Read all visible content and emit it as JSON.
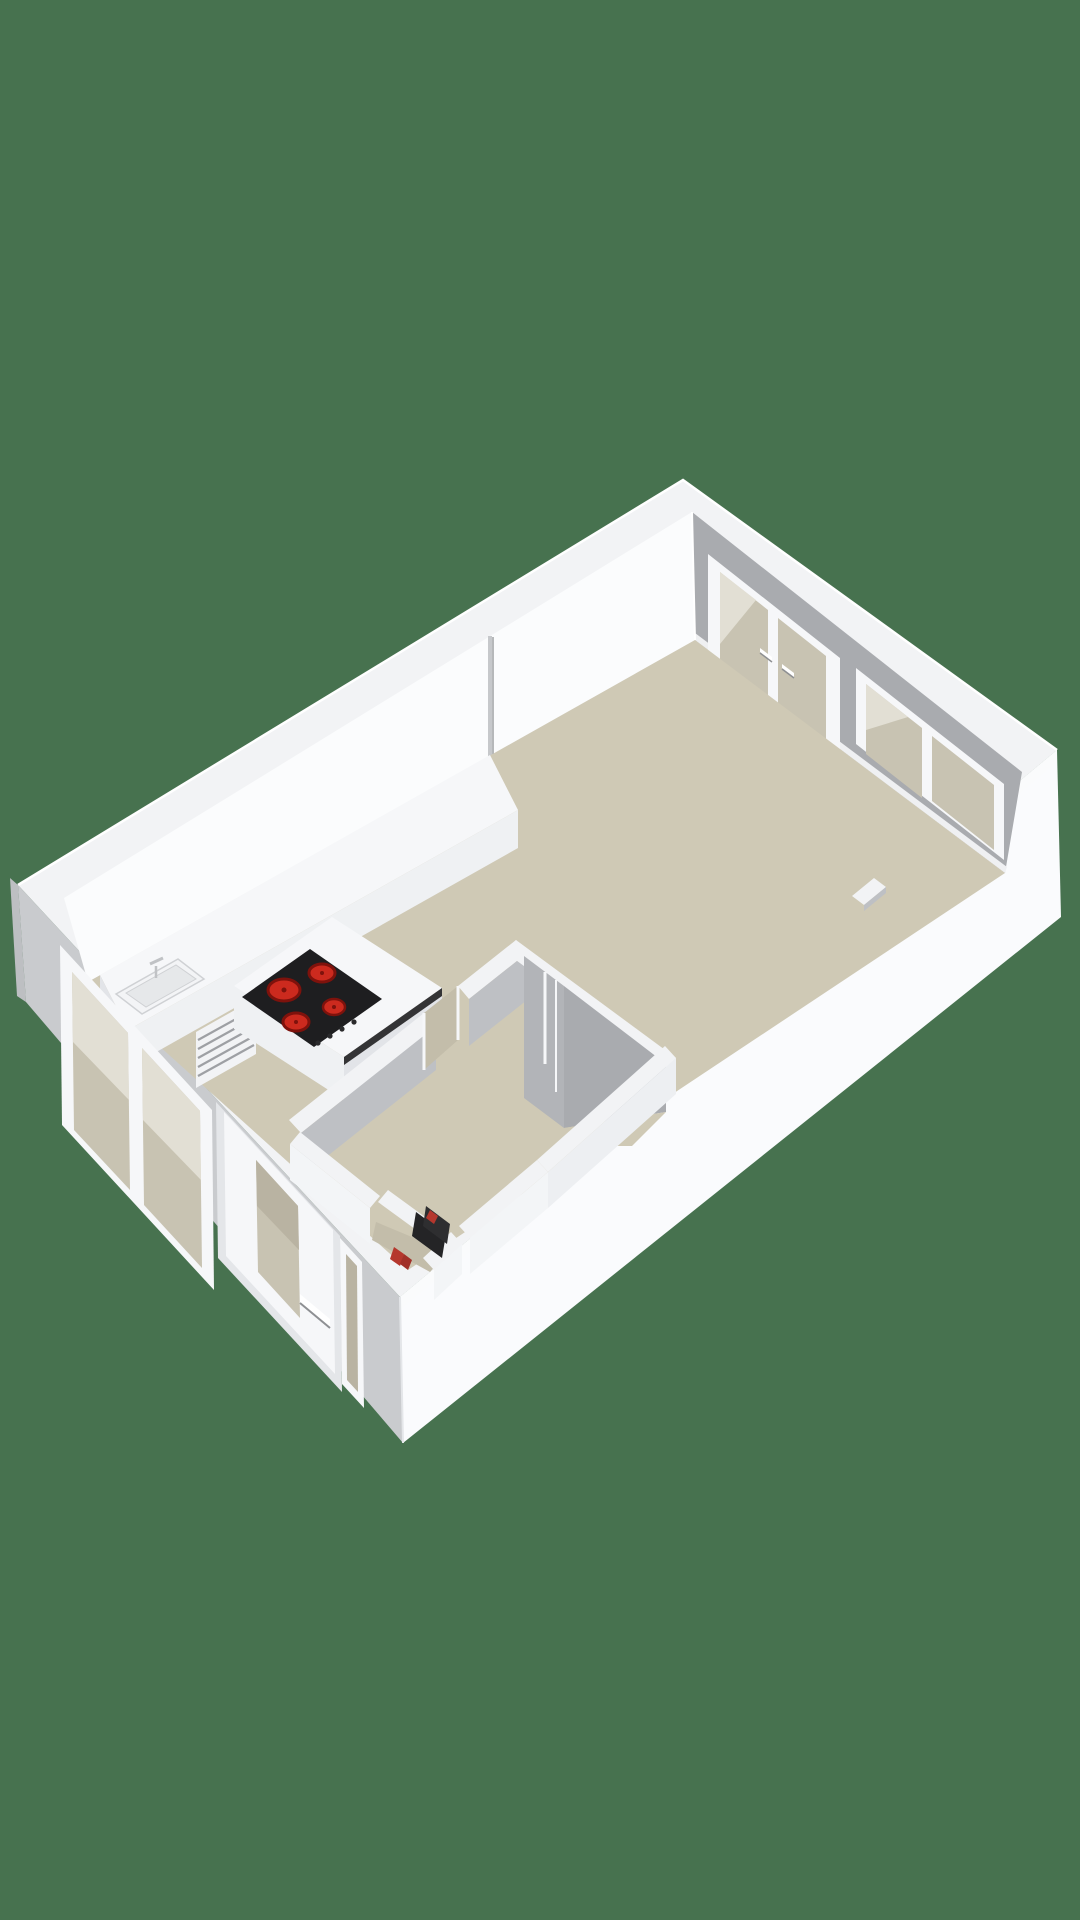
{
  "scene": {
    "type": "3d-floorplan-render",
    "view": "isometric studio apartment",
    "parts": [
      "exterior-walls",
      "living-room-floor",
      "kitchen-counter",
      "kitchen-sink",
      "appliance-louver-front",
      "cooktop-4-burners",
      "french-doors",
      "double-window-ne",
      "double-window-sw",
      "front-door",
      "sidelight-window",
      "bathroom-partitions",
      "utility-closet-boiler",
      "hallway"
    ]
  },
  "colors": {
    "background": "#47724F",
    "wall_top": "#F2F3F5",
    "wall_top_bright": "#FAFBFC",
    "edge_highlight": "#FFFFFF",
    "facade_sw": "#C9CBCE",
    "facade_w": "#BDBFC2",
    "facade_se": "#FAFBFD",
    "facade_se_shade": "#EDEFF2",
    "wall_nw": "#FBFCFD",
    "wall_ne": "#A9ABAF",
    "seam": "#C6C8CB",
    "seam_dark": "#9FA1A4",
    "partition_face_a": "#BEC0C4",
    "partition_face_b": "#B2B4B8",
    "partition_face_c": "#A9ABAF",
    "partition_face_light": "#EDEFF2",
    "partition_face_lighter": "#F3F5F7",
    "floor": "#CFC9B5",
    "floor_dark": "#C3BDAA",
    "glass": "#C8C3B2",
    "glass_light": "#E2DFD4",
    "glass_dark": "#B9B3A2",
    "frame": "#F6F7F9",
    "frame_shade": "#E4E6E9",
    "baseboard": "#EFF0F2",
    "counter_top": "#F6F7F9",
    "counter_front": "#EFF1F3",
    "counter_side": "#E2E4E8",
    "sink_rim": "#F3F4F6",
    "sink_edge": "#CFD1D4",
    "sink_basin": "#E6E8EA",
    "faucet": "#C0C2C5",
    "stripe": "#9EA0A4",
    "appliance_front": "#F2F3F5",
    "cooktop": "#1E1E20",
    "cooktop_side": "#343436",
    "burner": "#CC2A1E",
    "burner_dark": "#7E120C",
    "knob": "#2A2A2C",
    "boiler_dark": "#242426",
    "boiler_mid": "#2E2E30",
    "boiler_red": "#B5372D",
    "boiler_red_dark": "#A13028",
    "handle": "#FFFFFF",
    "handle_shadow": "#8E9093"
  }
}
